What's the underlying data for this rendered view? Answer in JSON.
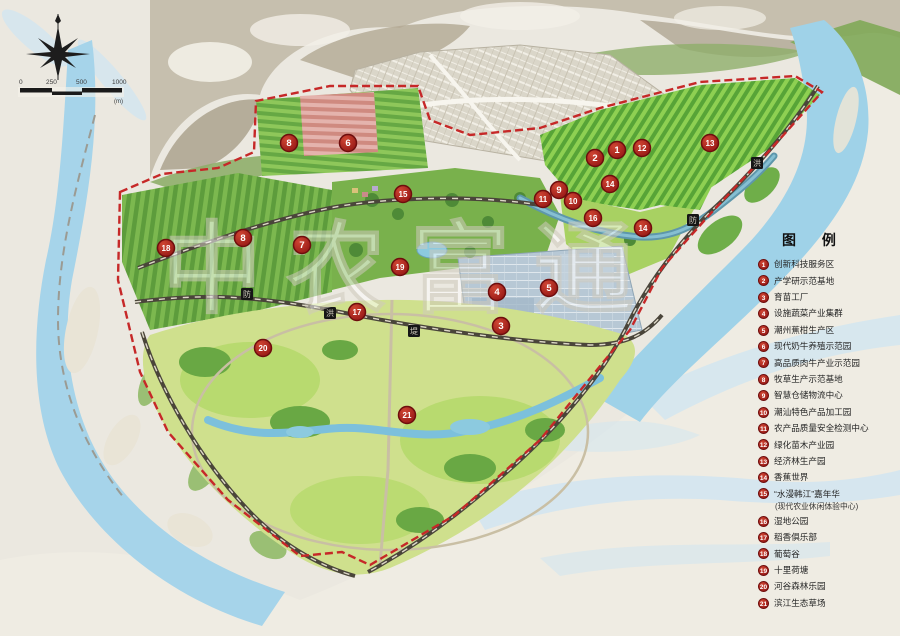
{
  "title": "农业园区总体规划图",
  "watermark": {
    "text": "中农富通"
  },
  "scale_bar": {
    "labels": [
      "0",
      "250",
      "500",
      "1000"
    ],
    "unit": "(m)"
  },
  "legend": {
    "title": "图 例",
    "items": [
      {
        "num": "1",
        "label": "创新科技服务区"
      },
      {
        "num": "2",
        "label": "产学研示范基地"
      },
      {
        "num": "3",
        "label": "育苗工厂"
      },
      {
        "num": "4",
        "label": "设施蔬菜产业集群"
      },
      {
        "num": "5",
        "label": "潮州蕉柑生产区"
      },
      {
        "num": "6",
        "label": "现代奶牛养殖示范园"
      },
      {
        "num": "7",
        "label": "高品质肉牛产业示范园"
      },
      {
        "num": "8",
        "label": "牧草生产示范基地"
      },
      {
        "num": "9",
        "label": "智慧仓储物流中心"
      },
      {
        "num": "10",
        "label": "潮汕特色产品加工园"
      },
      {
        "num": "11",
        "label": "农产品质量安全检测中心"
      },
      {
        "num": "12",
        "label": "绿化苗木产业园"
      },
      {
        "num": "13",
        "label": "经济林生产园"
      },
      {
        "num": "14",
        "label": "香蕉世界"
      },
      {
        "num": "15",
        "label": "“水漫韩江”嘉年华",
        "note": "(现代农业休闲体验中心)"
      },
      {
        "num": "16",
        "label": "湿地公园"
      },
      {
        "num": "17",
        "label": "稻香俱乐部"
      },
      {
        "num": "18",
        "label": "葡萄谷"
      },
      {
        "num": "19",
        "label": "十里荷塘"
      },
      {
        "num": "20",
        "label": "河谷森林乐园"
      },
      {
        "num": "21",
        "label": "滨江生态草场"
      }
    ]
  },
  "map": {
    "markers": [
      {
        "num": "8",
        "x": 289,
        "y": 143
      },
      {
        "num": "6",
        "x": 348,
        "y": 143
      },
      {
        "num": "15",
        "x": 403,
        "y": 194
      },
      {
        "num": "2",
        "x": 595,
        "y": 158
      },
      {
        "num": "1",
        "x": 617,
        "y": 150
      },
      {
        "num": "12",
        "x": 642,
        "y": 148
      },
      {
        "num": "13",
        "x": 710,
        "y": 143
      },
      {
        "num": "9",
        "x": 559,
        "y": 190
      },
      {
        "num": "14",
        "x": 610,
        "y": 184
      },
      {
        "num": "11",
        "x": 543,
        "y": 199
      },
      {
        "num": "10",
        "x": 573,
        "y": 201
      },
      {
        "num": "16",
        "x": 593,
        "y": 218
      },
      {
        "num": "14",
        "x": 643,
        "y": 228
      },
      {
        "num": "18",
        "x": 166,
        "y": 248
      },
      {
        "num": "8",
        "x": 243,
        "y": 238
      },
      {
        "num": "7",
        "x": 302,
        "y": 245
      },
      {
        "num": "19",
        "x": 400,
        "y": 267
      },
      {
        "num": "4",
        "x": 497,
        "y": 292
      },
      {
        "num": "5",
        "x": 549,
        "y": 288
      },
      {
        "num": "3",
        "x": 501,
        "y": 326
      },
      {
        "num": "17",
        "x": 357,
        "y": 312
      },
      {
        "num": "20",
        "x": 263,
        "y": 348
      },
      {
        "num": "21",
        "x": 407,
        "y": 415
      }
    ],
    "road_labels": [
      {
        "text": "防",
        "x": 247,
        "y": 294
      },
      {
        "text": "洪",
        "x": 330,
        "y": 313
      },
      {
        "text": "堤",
        "x": 414,
        "y": 331
      },
      {
        "text": "洪",
        "x": 757,
        "y": 163
      },
      {
        "text": "防",
        "x": 693,
        "y": 220
      }
    ]
  },
  "colors": {
    "marker_red": "#a81b1b",
    "boundary_red": "#c62828",
    "water": "#a6d4ea",
    "field_green": "#7cb84f",
    "park_green": "#cfe08d",
    "greenhouse_gray": "#b7c8d5",
    "paper": "#ebe8e0"
  }
}
